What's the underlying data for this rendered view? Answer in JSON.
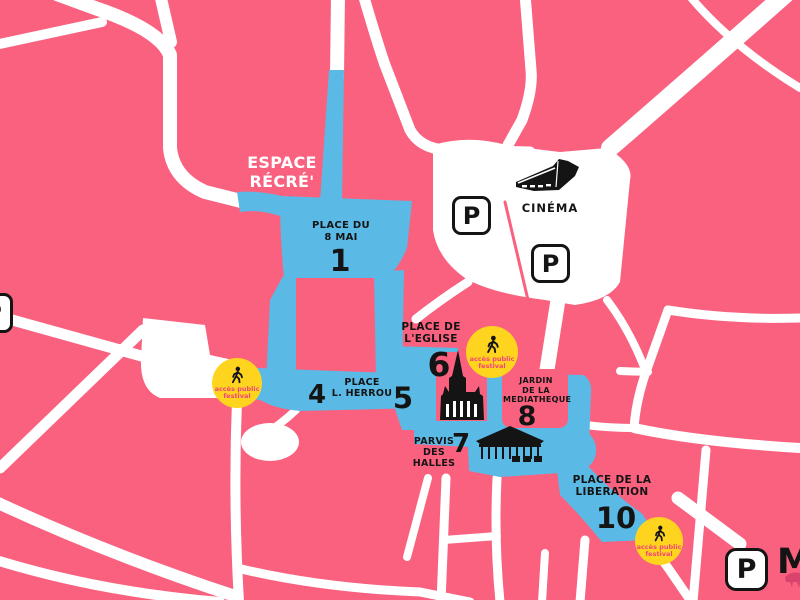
{
  "map": {
    "colors": {
      "background_pink": "#F9617F",
      "street_white": "#FFFFFF",
      "festival_zone_blue": "#5BB9E5",
      "access_badge_yellow": "#FFD41E",
      "access_badge_text_pink": "#F2437A",
      "label_black": "#141414",
      "espace_recre_text_white": "#FFFFFF"
    },
    "espace_recre": {
      "line1": "ESPACE",
      "line2": "RÉCRÉ'"
    },
    "cinema": {
      "label": "CINÉMA"
    },
    "parking": {
      "letter": "P"
    },
    "access_badge": {
      "line1": "accès public",
      "line2": "festival"
    },
    "places": {
      "place_du_8_mai": {
        "line1": "PLACE DU",
        "line2": "8 MAI",
        "number": "1"
      },
      "place_de_l_eglise": {
        "line1": "PLACE DE",
        "line2": "L'EGLISE",
        "number": "6"
      },
      "place_l_herrou": {
        "line1": "PLACE",
        "line2": "L. HERROU",
        "number_left": "4",
        "number_right": "5"
      },
      "jardin_de_la_mediatheque": {
        "line1": "JARDIN",
        "line2": "DE LA",
        "line3": "MEDIATHEQUE",
        "number": "8"
      },
      "parvis_des_halles": {
        "line1": "PARVIS",
        "line2": "DES",
        "line3": "HALLES",
        "number": "7"
      },
      "place_de_la_liberation": {
        "line1": "PLACE DE LA",
        "line2": "LIBERATION",
        "number": "10"
      }
    },
    "partial_labels": {
      "m": "M"
    }
  }
}
